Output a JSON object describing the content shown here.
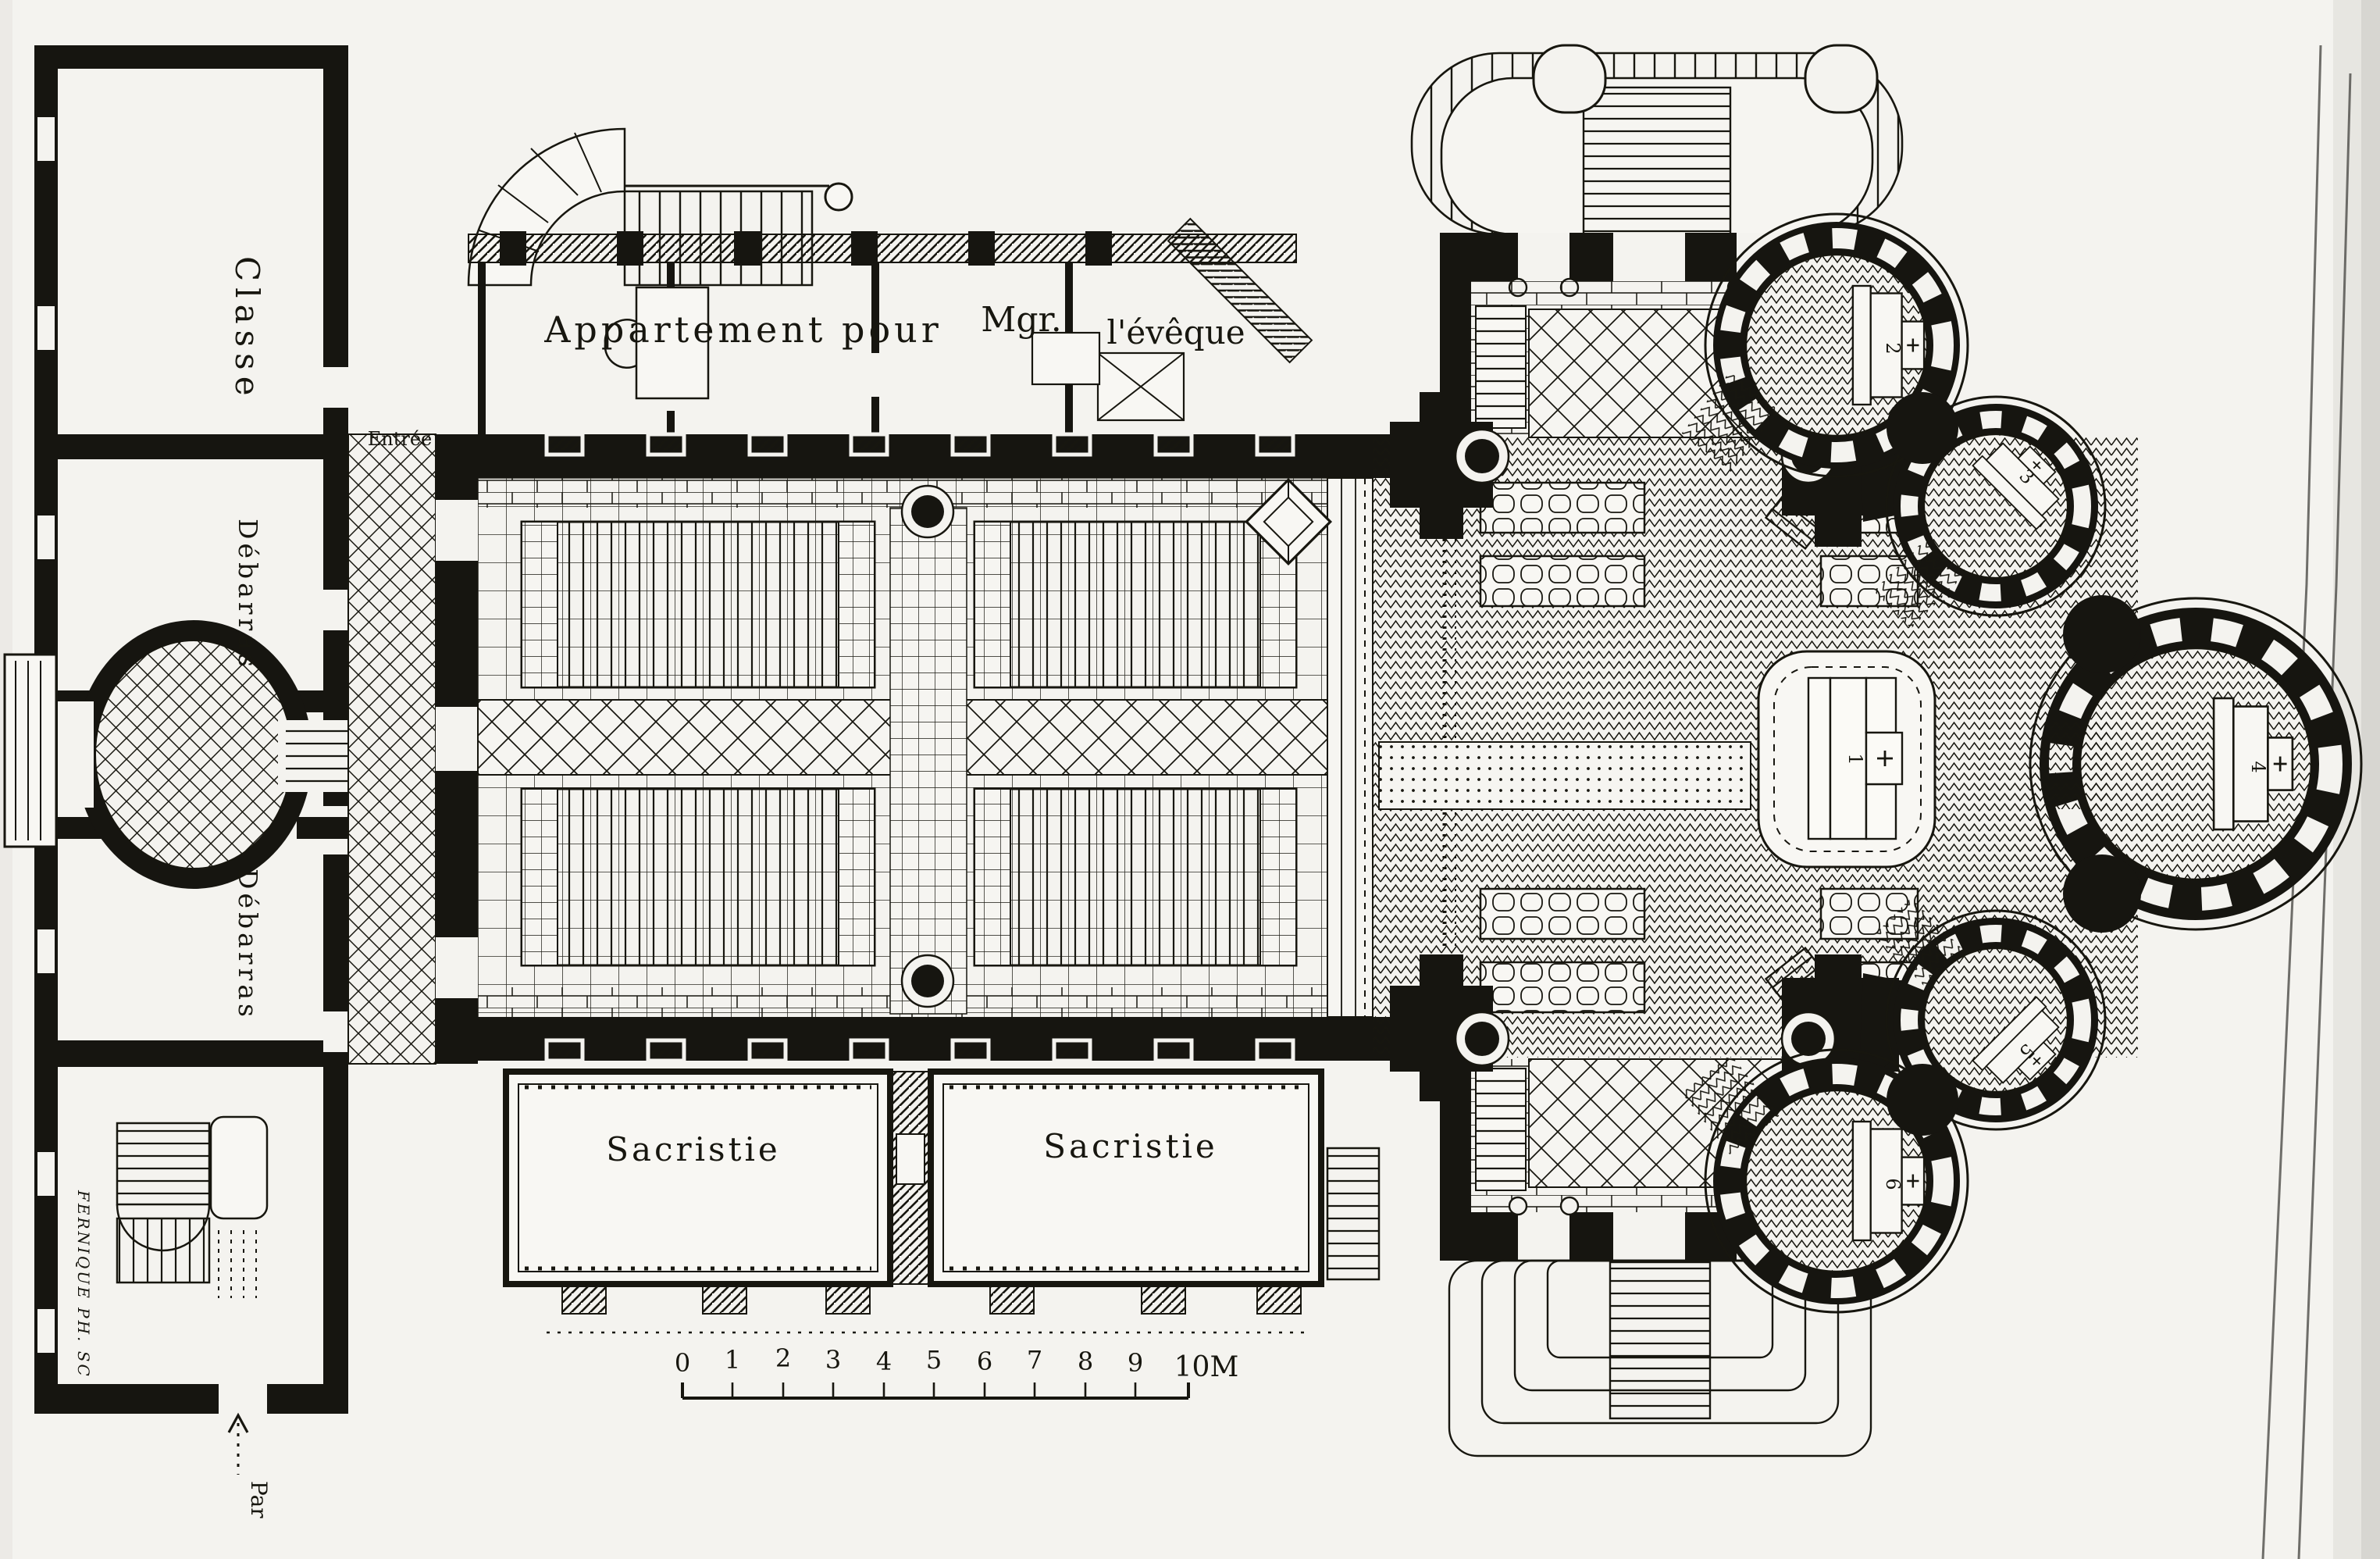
{
  "palette": {
    "ink": "#17160f",
    "paper": "#f4f3ef",
    "wall_black": "#161510",
    "scan_shadow": "#dcdbd6"
  },
  "rooms": {
    "classe": "Classe",
    "debarras_upper": "Débarras",
    "debarras_lower": "Débarras",
    "sacristie_left": "Sacristie",
    "sacristie_right": "Sacristie"
  },
  "apartment": {
    "line_main": "Appartement pour",
    "title_abbr": "Mgr.",
    "title_rest": "l'évêque"
  },
  "entrance_label": "Entrée",
  "path_label": "Par",
  "engraver_credit": "FERNIQUE PH. SC",
  "scale_bar": {
    "ticks": [
      "0",
      "1",
      "2",
      "3",
      "4",
      "5",
      "6",
      "7",
      "8",
      "9"
    ],
    "end_label": "10M"
  },
  "altar_numbers": [
    "1",
    "2",
    "3",
    "4",
    "5",
    "6"
  ]
}
